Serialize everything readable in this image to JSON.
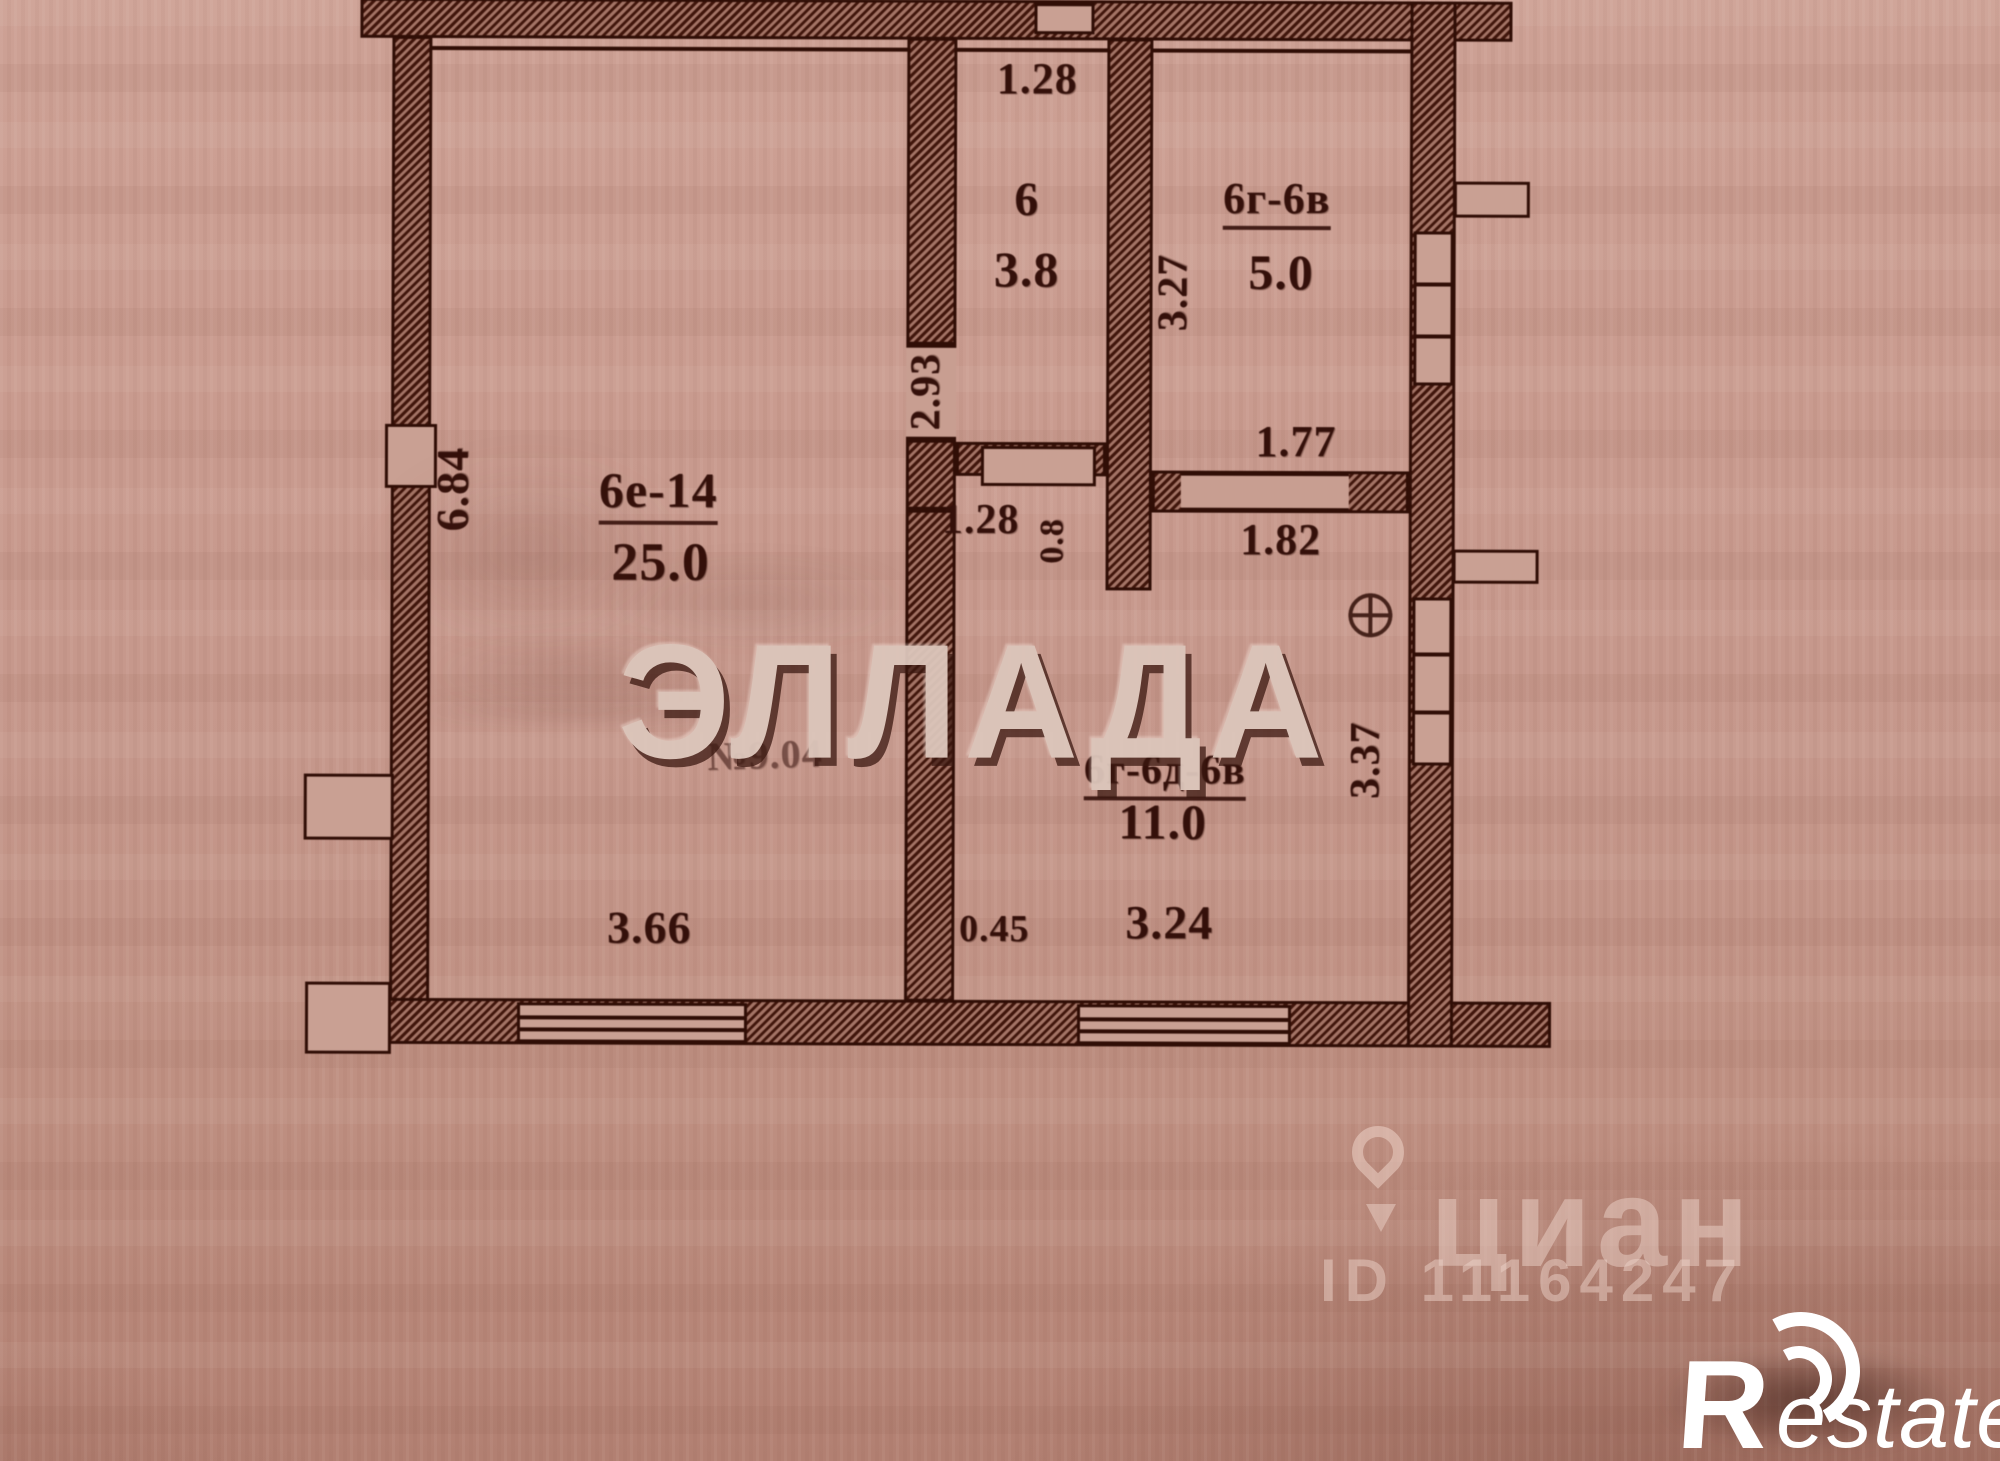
{
  "plan": {
    "rooms": [
      {
        "key": "living",
        "label": "6е-14",
        "area": "25.0"
      },
      {
        "key": "closet",
        "label": "6",
        "area": "3.8"
      },
      {
        "key": "storage",
        "label": "6г-6в",
        "area": "5.0"
      },
      {
        "key": "kitchen",
        "label": "6г-6д-6в",
        "area": "11.0"
      }
    ],
    "note": "№9.04",
    "dims": {
      "closet_width": "1.28",
      "closet_height": "2.93",
      "storage_height": "3.27",
      "storage_width": "1.77",
      "living_height": "6.84",
      "hall_width": "1.28",
      "hall_depth": "0.8",
      "door_span": "1.82",
      "kitchen_height": "3.37",
      "living_width": "3.66",
      "ledge": "0.45",
      "kitchen_width": "3.24"
    }
  },
  "watermarks": {
    "center": "ЭЛЛАДА",
    "cian_name": "циан",
    "cian_id": "ID 11164247",
    "restate_r": "R",
    "restate_rest": "estate"
  },
  "colors": {
    "ink": "#300e06",
    "paper": "#c79b8f",
    "watermark_fill": "#dcc6bb",
    "logo_white": "#ffffff"
  }
}
